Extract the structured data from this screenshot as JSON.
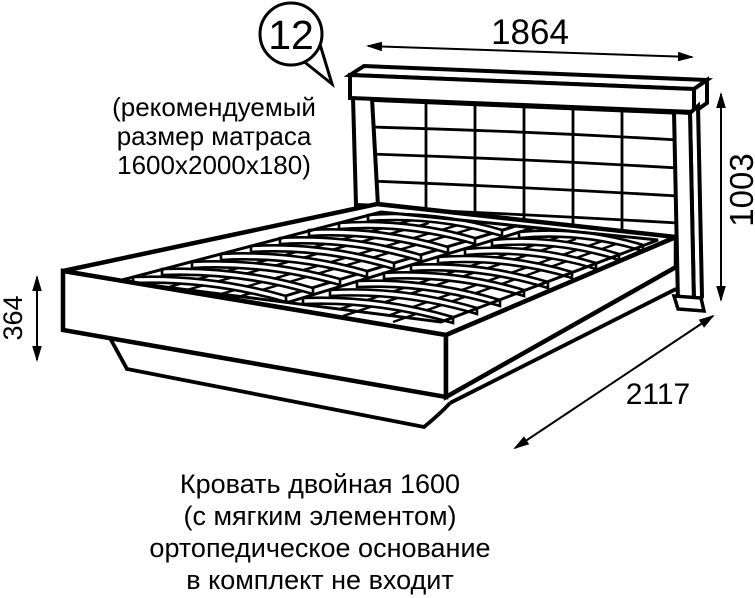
{
  "callout": {
    "number": "12"
  },
  "note": {
    "lines": [
      "(рекомендуемый",
      "размер матраса",
      "1600х2000х180)"
    ]
  },
  "dimensions": {
    "headboard_width": "1864",
    "headboard_height": "1003",
    "frame_height": "364",
    "bed_length": "2117"
  },
  "caption": {
    "lines": [
      "Кровать двойная 1600",
      "(с мягким элементом)",
      "ортопедическое основание",
      "в комплект не входит"
    ]
  },
  "colors": {
    "ink": "#000000",
    "background": "#ffffff"
  }
}
